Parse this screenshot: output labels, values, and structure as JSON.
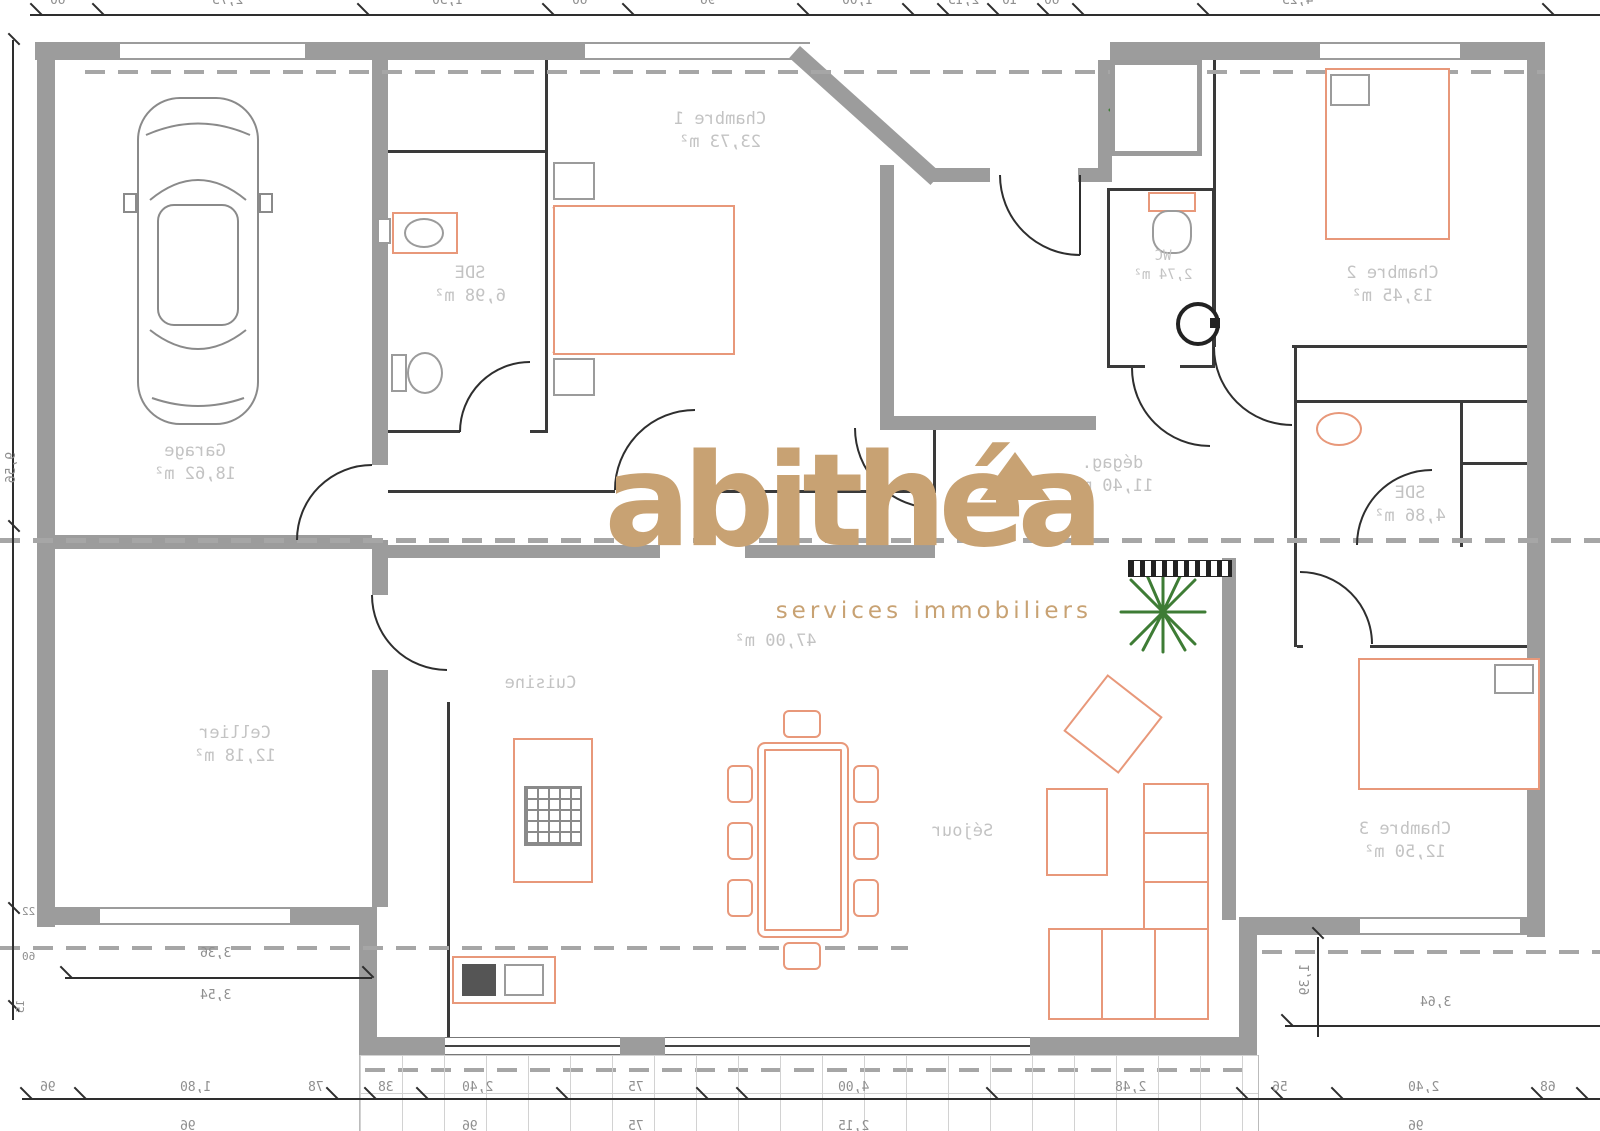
{
  "brand": {
    "logo": "abithéa",
    "tagline": "services immobiliers"
  },
  "rooms": {
    "garage": {
      "name": "Garage",
      "area": "18,62 m²"
    },
    "sde1": {
      "name": "SDE",
      "area": "6,98 m²"
    },
    "chambre1": {
      "name": "Chambre 1",
      "area": "23,73 m²"
    },
    "wc": {
      "name": "WC",
      "area": "2,74 m²"
    },
    "chambre2": {
      "name": "Chambre 2",
      "area": "13,45 m²"
    },
    "degagement": {
      "name": "dégag.",
      "area": "11,40 m²"
    },
    "sde2": {
      "name": "SDE",
      "area": "4,86 m²"
    },
    "cellier": {
      "name": "Cellier",
      "area": "12,18 m²"
    },
    "cuisine": {
      "name": "Cuisine"
    },
    "sejour": {
      "name": "Séjour"
    },
    "chambre3": {
      "name": "Chambre 3",
      "area": "12,50 m²"
    },
    "living_total": "47,00 m²"
  },
  "dimensions": {
    "top": [
      "60",
      "2,75",
      "1,50",
      "60",
      "96",
      "1,00",
      "2,15",
      "10",
      "60",
      "4,25"
    ],
    "bottom": [
      "96",
      "1,80",
      "78",
      "38",
      "2,40",
      "75",
      "4,00",
      "2,48",
      "56",
      "2,40",
      "68"
    ],
    "bottom_row2": [
      "96",
      "96",
      "75",
      "2,15",
      "96"
    ],
    "left": {
      "vertical": "9,56",
      "small": [
        "22",
        "60",
        "15"
      ]
    },
    "bottom_left": {
      "above": "3,36",
      "below": "3,54"
    },
    "bottom_right": {
      "width": "3,64",
      "height": "1,39"
    }
  },
  "colors": {
    "wall": "#9c9c9c",
    "furniture": "#e8987a",
    "logo": "#c8a273",
    "plant": "#3e7c35",
    "room_label": "#c3c3c3",
    "dimension_text": "#8f8f8f"
  }
}
